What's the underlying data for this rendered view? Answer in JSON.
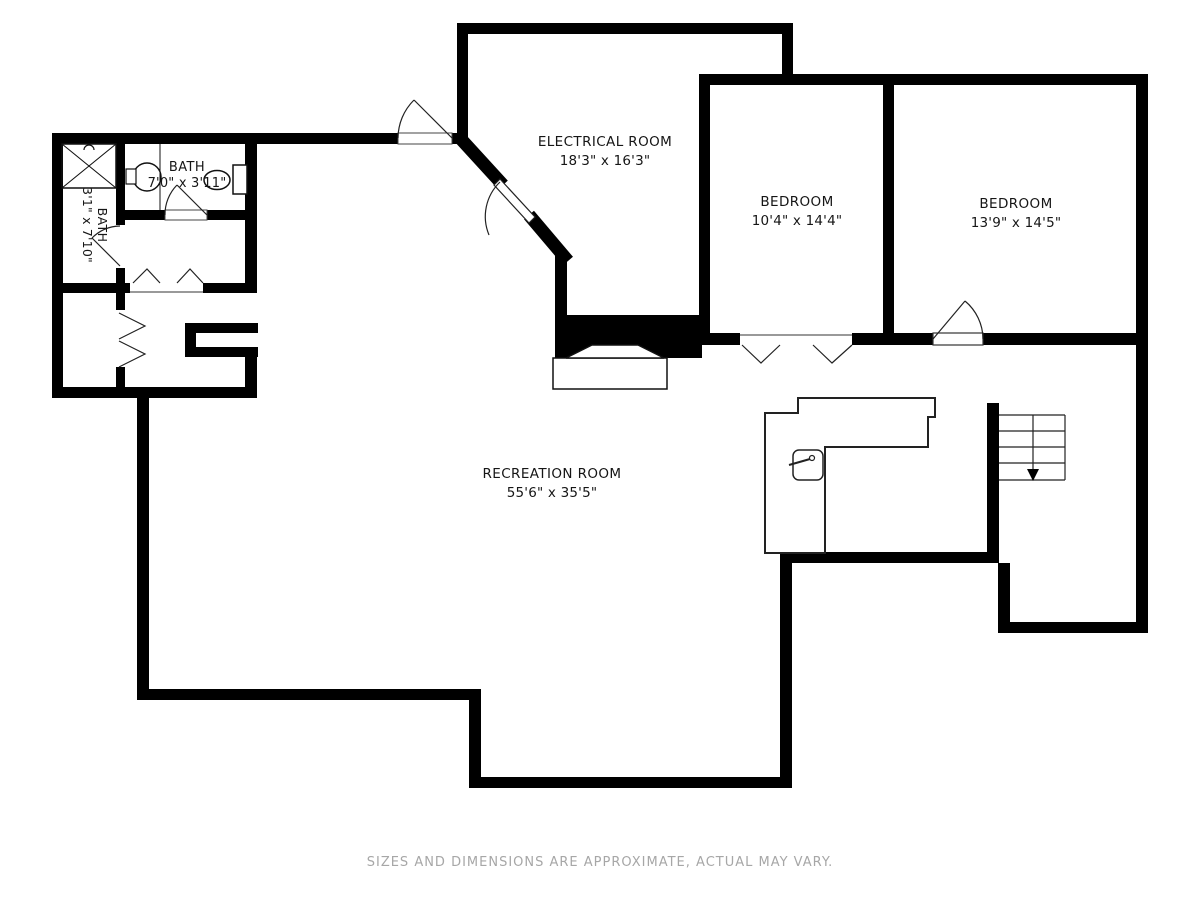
{
  "rooms": [
    {
      "name": "ELECTRICAL ROOM",
      "dims": "18'3\" x 16'3\""
    },
    {
      "name": "BEDROOM",
      "dims": "10'4\" x 14'4\""
    },
    {
      "name": "BEDROOM",
      "dims": "13'9\" x 14'5\""
    },
    {
      "name": "BATH",
      "dims": "7'0\" x 3'11\""
    },
    {
      "name": "BATH",
      "dims": "3'1\" x 7'10\""
    },
    {
      "name": "RECREATION ROOM",
      "dims": "55'6\" x 35'5\""
    }
  ],
  "footer": {
    "disclaimer": "SIZES AND DIMENSIONS ARE APPROXIMATE, ACTUAL MAY VARY."
  },
  "colors": {
    "wall": "#000000",
    "thin_line": "#222222",
    "label_text": "#161616",
    "disclaimer_text": "#a7a7a7",
    "background": "#ffffff"
  }
}
